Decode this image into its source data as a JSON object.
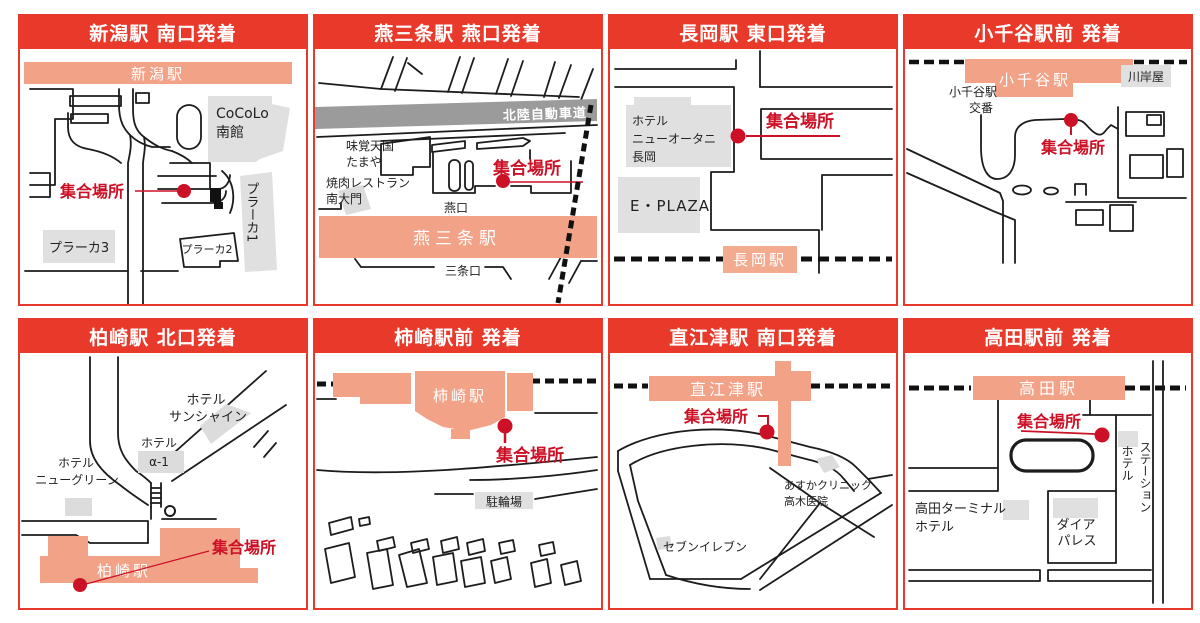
{
  "page": {
    "background": "#ffffff"
  },
  "colors": {
    "header_red": "#e8392a",
    "meet_red": "#cc1126",
    "station_salmon": "#f2a287",
    "station_salmon_light": "#f3ab90",
    "building_gray": "#e0e0e0",
    "expressway_gray": "#9b9b9b",
    "road_black": "#1c1c1c"
  },
  "meet_label": "集合場所",
  "panels": [
    {
      "id": "niigata",
      "title": "新潟駅 南口発着",
      "station": "新潟駅",
      "labels": {
        "cocolo_line1": "CoCoLo",
        "cocolo_line2": "南館",
        "plaka1": "プラーカ1",
        "plaka2": "プラーカ2",
        "plaka3": "プラーカ3"
      }
    },
    {
      "id": "tsubame-sanjo",
      "title": "燕三条駅 燕口発着",
      "station": "燕三条駅",
      "labels": {
        "expressway": "北陸自動車道",
        "mikaku_line1": "味覚天国",
        "mikaku_line2": "たまや",
        "yakiniku_line1": "焼肉レストラン",
        "yakiniku_line2": "南大門",
        "exit_tsubame": "燕口",
        "exit_sanjo": "三条口"
      }
    },
    {
      "id": "nagaoka",
      "title": "長岡駅 東口発着",
      "station": "長岡駅",
      "labels": {
        "hotel_line1": "ホテル",
        "hotel_line2": "ニューオータニ",
        "hotel_line3": "長岡",
        "eplaza": "E・PLAZA"
      }
    },
    {
      "id": "ojiya",
      "title": "小千谷駅前 発着",
      "station": "小千谷駅",
      "labels": {
        "koban_line1": "小千谷駅",
        "koban_line2": "交番",
        "kawagishiya": "川岸屋"
      }
    },
    {
      "id": "kashiwazaki",
      "title": "柏崎駅 北口発着",
      "station": "柏崎駅",
      "labels": {
        "sunshine_line1": "ホテル",
        "sunshine_line2": "サンシャイン",
        "alpha_line1": "ホテル",
        "alpha_line2": "α-1",
        "newgreen_line1": "ホテル",
        "newgreen_line2": "ニューグリーン"
      }
    },
    {
      "id": "kakizaki",
      "title": "柿崎駅前 発着",
      "station": "柿崎駅",
      "labels": {
        "bicycle_parking": "駐輪場"
      }
    },
    {
      "id": "naoetsu",
      "title": "直江津駅 南口発着",
      "station": "直江津駅",
      "labels": {
        "clinic_line1": "あすかクリニック",
        "clinic_line2": "高木医院",
        "seven_eleven": "セブンイレブン"
      }
    },
    {
      "id": "takada",
      "title": "高田駅前 発着",
      "station": "高田駅",
      "labels": {
        "station_hotel_col1": "ステーション",
        "station_hotel_col2": "ホテル",
        "terminal_line1": "高田ターミナル",
        "terminal_line2": "ホテル",
        "dia_line1": "ダイア",
        "dia_line2": "パレス"
      }
    }
  ]
}
